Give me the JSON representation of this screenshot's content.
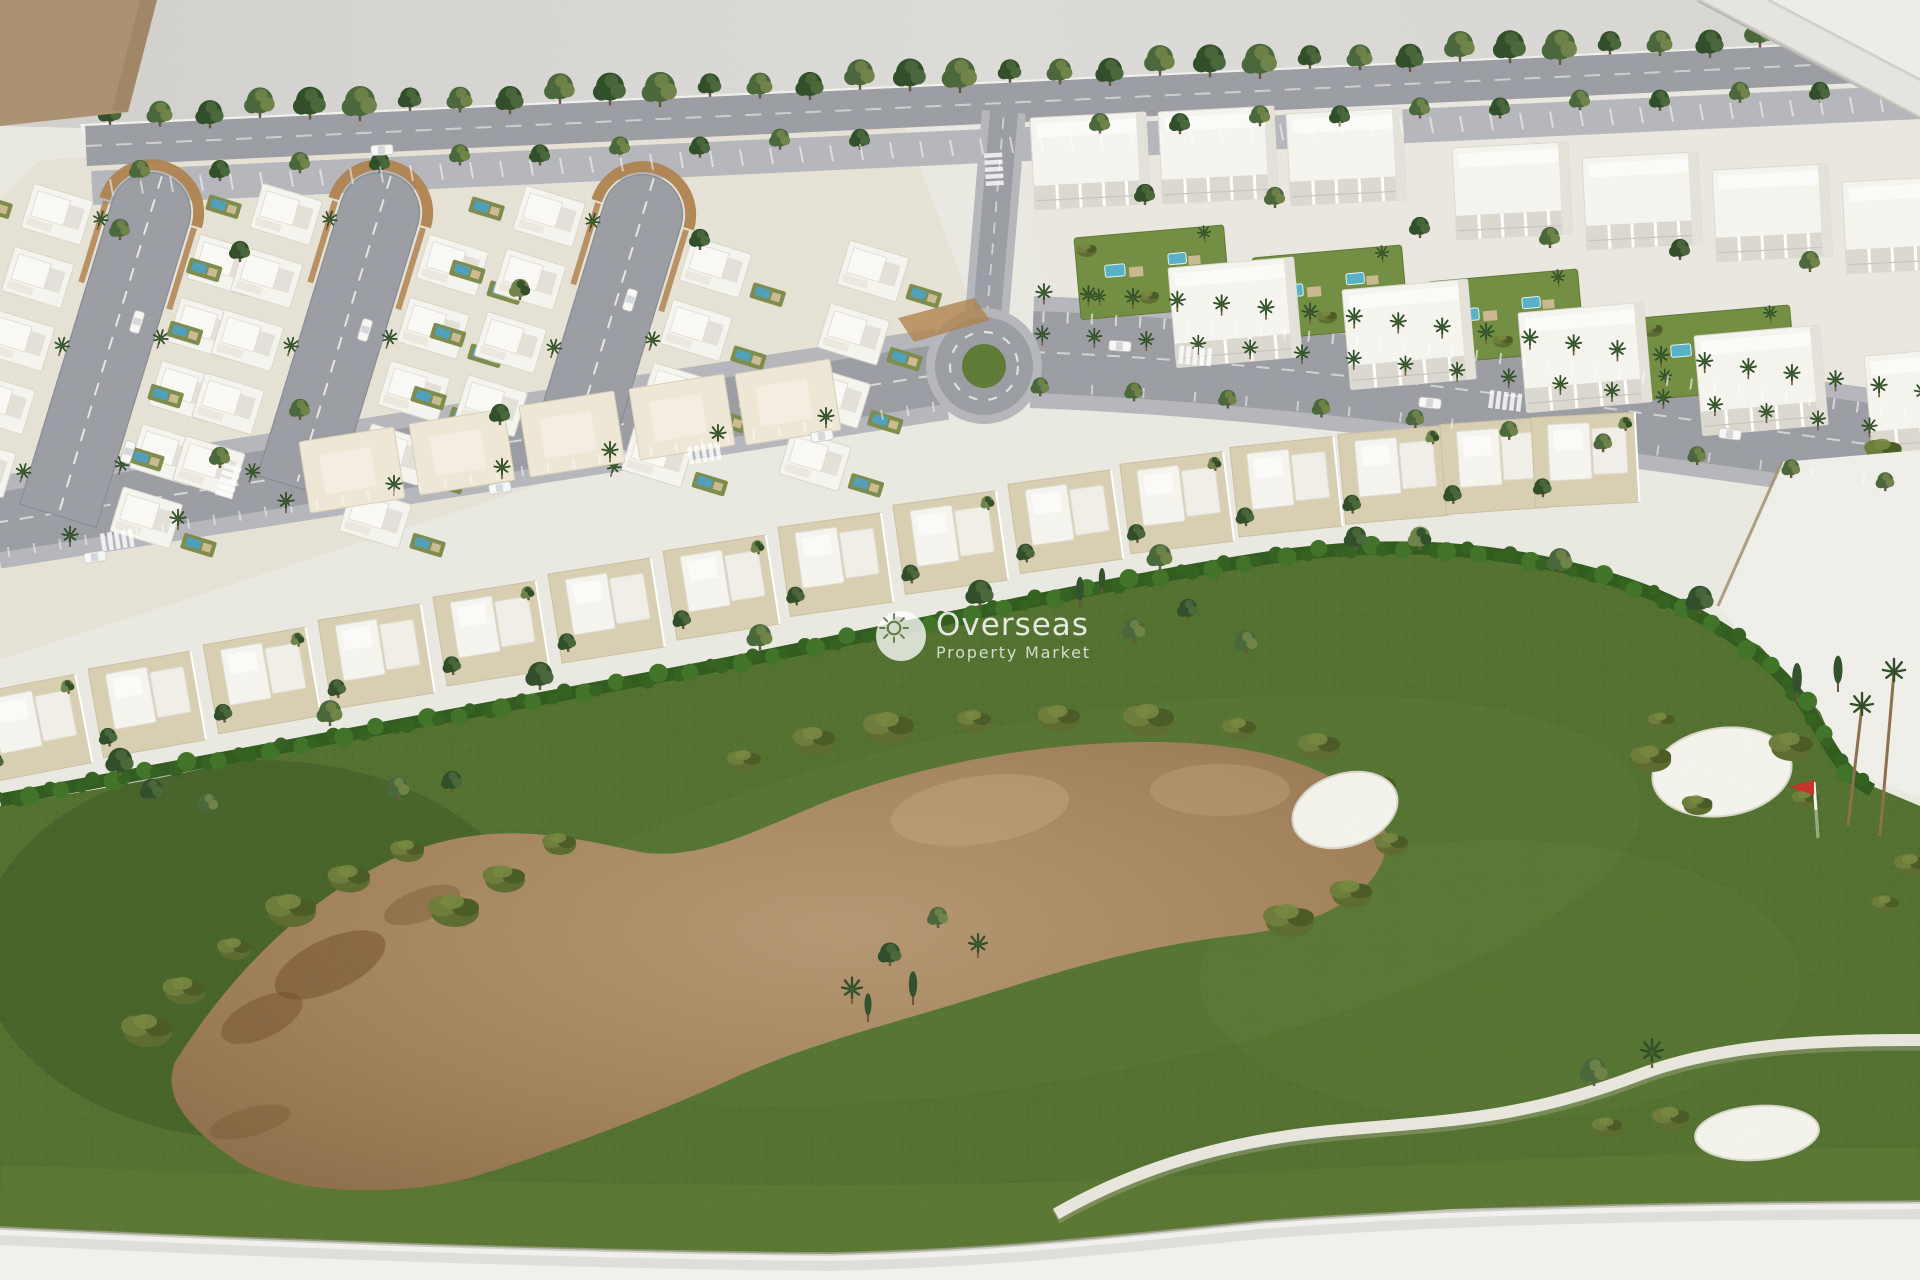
{
  "image_type": "photograph",
  "subject": "Aerial photo of an architectural scale model (maquette) of a golf-resort residential development with white villas, apartment blocks, palm-lined avenues, a roundabout and a golf course with bunkers and a flag",
  "watermark": {
    "brand": "Overseas",
    "tagline": "Property Market",
    "icon": "sun-icon"
  },
  "scene": {
    "regions": [
      "backdrop-wall",
      "leaning-panel-top-right",
      "cardboard-corner-top-left",
      "model-base",
      "top-boundary-street-with-trees",
      "villa-district-with-hairpin-streets",
      "apartment-district-with-garden-pools",
      "palm-boulevard",
      "roundabout",
      "townhouse-row",
      "empty-white-parcel",
      "golf-course",
      "dirt-waste-area",
      "sand-bunkers",
      "golf-flag",
      "cart-path",
      "model-base-front-edge"
    ]
  },
  "palette": {
    "backdrop": "#d9d7d4",
    "backdrop_panel": "#efede9",
    "cardboard": "#ab9170",
    "base_white": "#eae9e2",
    "base_edge": "#f2f1ed",
    "road": "#9b9da4",
    "road_light": "#b6b7bc",
    "marking": "#ffffff",
    "kerb_brown": "#b0824e",
    "plot_tan": "#d9cfb2",
    "ground_tan": "#e3dcc8",
    "villa_white": "#f6f5ef",
    "villa_shade": "#dedcd2",
    "roof_cream": "#efe8d6",
    "pool_blue": "#4f9fba",
    "garden_olive": "#7d8b4b",
    "grass": "#52702e",
    "grass_light": "#5f7d34",
    "grass_dark": "#3f5a26",
    "dirt": "#a98a62",
    "dirt_dark": "#6e4c28",
    "dirt_edge": "#8f7450",
    "hedge": "#2f5a1d",
    "bush": "#657231",
    "tree_dark": "#2f4d28",
    "tree_mid": "#49663a",
    "tree_light": "#6f8348",
    "trunk": "#6b5337",
    "sand_white": "#f4f3ec",
    "path_white": "#e9e7dd",
    "flag_red": "#c43327",
    "sun_glyph": "#6e7d4a",
    "watermark_white": "rgba(255,255,255,0.85)"
  }
}
